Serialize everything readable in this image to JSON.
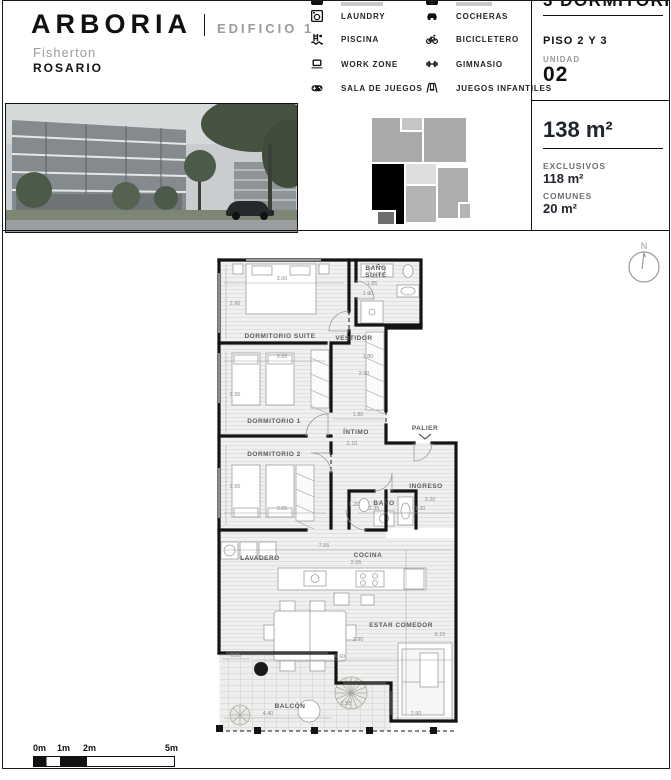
{
  "header": {
    "brand": "ARBORIA",
    "building": "EDIFICIO 1",
    "neighborhood": "Fisherton",
    "city": "ROSARIO"
  },
  "amenities": {
    "left": [
      {
        "icon": "laundry-icon",
        "label": "LAUNDRY"
      },
      {
        "icon": "pool-icon",
        "label": "PISCINA"
      },
      {
        "icon": "workzone-icon",
        "label": "WORK ZONE"
      },
      {
        "icon": "gameroom-icon",
        "label": "SALA DE JUEGOS"
      }
    ],
    "right": [
      {
        "icon": "car-icon",
        "label": "COCHERAS"
      },
      {
        "icon": "bicycle-icon",
        "label": "BICICLETERO"
      },
      {
        "icon": "gym-icon",
        "label": "GIMNASIO"
      },
      {
        "icon": "playground-icon",
        "label": "JUEGOS INFANTILES"
      }
    ]
  },
  "unit_panel": {
    "title": "3 DORMITORIOS",
    "floor": "PISO 2 Y 3",
    "unit_label": "UNIDAD",
    "unit_number": "02",
    "total_area": "138 m²",
    "exclusive_label": "EXCLUSIVOS",
    "exclusive_area": "118 m²",
    "common_label": "COMUNES",
    "common_area": "20 m²"
  },
  "compass": {
    "label": "N"
  },
  "floorplan": {
    "labels": {
      "suite": "DORMITORIO SUITE",
      "bano_suite_1": "BAÑO",
      "bano_suite_2": "SUITE",
      "vestidor": "VESTIDOR",
      "dorm1": "DORMITORIO 1",
      "intimo": "ÍNTIMO",
      "palier": "PALIER",
      "dorm2": "DORMITORIO 2",
      "bano": "BAÑO",
      "ingreso": "INGRESO",
      "lavadero": "LAVADERO",
      "cocina": "COCINA",
      "estar": "ESTAR COMEDOR",
      "balcon": "BALCÓN"
    },
    "dims": {
      "suite_w": "3.60",
      "suite_h": "2.90",
      "bano_suite_w": "1.85",
      "bano_suite_h": "1.90",
      "vestidor_w": "1.80",
      "vestidor_h": "2.90",
      "dorm1_w": "3.65",
      "dorm1_h": "2.95",
      "intimo_w": "1.80",
      "intimo_h": "2.10",
      "dorm2_h": "2.95",
      "dorm2_w": "3.65",
      "bano_w": "1.20",
      "bano_l": "2.35",
      "ingreso_l": "3.20",
      "ingreso_w": "1.30",
      "plan_w": "7.55",
      "cocina_w": "2.05",
      "estar_w": "2.90",
      "estar_l": "6.15",
      "balcon_d": "0.85",
      "balcon_w": "6.60",
      "balcon_l": "4.40",
      "balcon_h": "1.55",
      "sofa_w": "2.90"
    }
  },
  "scalebar": {
    "t0": "0m",
    "t1": "1m",
    "t2": "2m",
    "t5": "5m"
  }
}
